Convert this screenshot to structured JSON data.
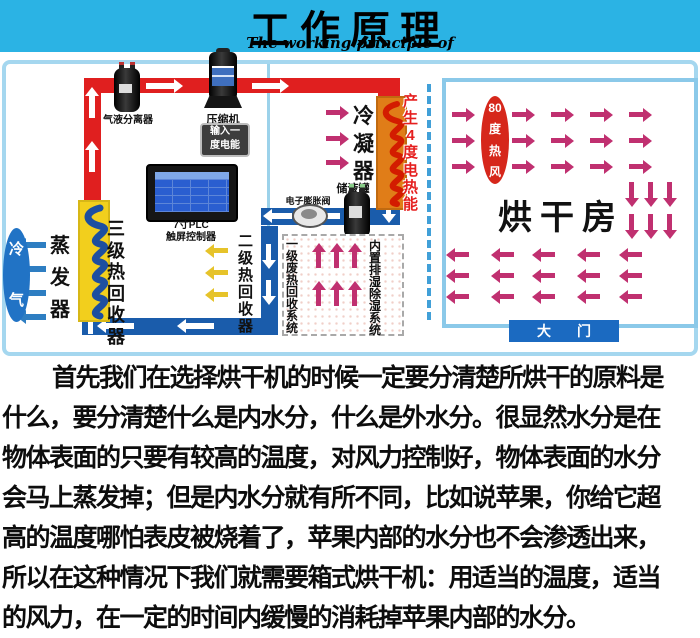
{
  "title": {
    "zh": "工作原理",
    "en": "The working principle of"
  },
  "diagram": {
    "gas_liquid_separator": "气液分离器",
    "compressor": "压缩机",
    "input_energy_line1": "输入一",
    "input_energy_line2": "度电能",
    "plc_line1": "7寸PLC",
    "plc_line2": "触屏控制器",
    "recovery3": "三级热回收器",
    "evaporator": "蒸发器",
    "cold_air": "冷气",
    "recovery2": "二级热回收器",
    "condenser": "冷凝器",
    "heat_energy": "产生4度电热能",
    "expansion_valve": "电子膨胀阀",
    "liquid_tank": "储液罐",
    "waste_heat_system": "一级废热回收系统",
    "dehumidify_system": "内置排湿除湿系统",
    "hot_wind": "80度热风",
    "drying_room": "烘干房",
    "door": "大门"
  },
  "paragraph": {
    "lines": [
      "首先我们在选择烘干机的时候一定要分清楚所烘干的原料是",
      "什么，要分清楚什么是内水分，什么是外水分。很显然水分是在",
      "物体表面的只要有较高的温度，对风力控制好，物体表面的水分",
      "会马上蒸发掉；但是内水分就有所不同，比如说苹果，你给它超",
      "高的温度哪怕表皮被烧着了，苹果内部的水分也不会渗透出来，",
      "所以在这种情况下我们就需要箱式烘干机：用适当的温度，适当",
      "的风力，在一定的时间内缓慢的消耗掉苹果内部的水分。"
    ]
  },
  "colors": {
    "banner_cyan": "#2bb3e4",
    "pipe_red": "#e01f1f",
    "pipe_blue": "#1a5cab",
    "arrow_magenta": "#c03070",
    "arrow_yellow": "#e6c32a",
    "arrow_blue": "#2e7ec2",
    "coil_yellow": "#f2cf1d",
    "coil_orange": "#e07d18",
    "room_border": "#8bc9e9",
    "door_blue": "#1b6ac1",
    "oval_red": "#d6271b"
  }
}
